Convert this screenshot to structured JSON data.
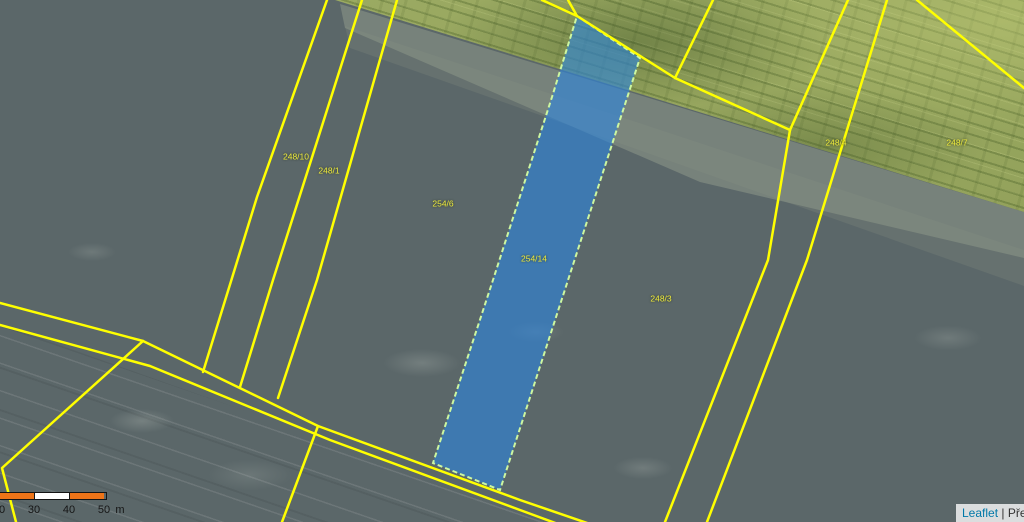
{
  "map": {
    "kind": "cadastral-parcel-map-over-aerial-imagery",
    "highlighted_parcel": "254/14",
    "parcel_labels": [
      {
        "text": "248/10"
      },
      {
        "text": "248/1"
      },
      {
        "text": "254/6"
      },
      {
        "text": "254/14"
      },
      {
        "text": "248/3"
      },
      {
        "text": "248/4"
      },
      {
        "text": "248/7"
      }
    ],
    "colors": {
      "parcel_line": "#ffff00",
      "highlight_fill": "#2b85e0",
      "highlight_border": "#cdf7a0",
      "scale_orange": "#ee7418",
      "scale_white": "#ffffff",
      "attribution_link": "#0078a8",
      "field_dark": "#5b6769",
      "field_green": "#96a45e"
    },
    "scale_bar": {
      "tick_labels": [
        "20",
        "30",
        "40",
        "50"
      ],
      "unit": "m"
    },
    "attribution": {
      "library_link": "Leaflet",
      "separator": "|",
      "text_fragment": "Pře"
    }
  }
}
